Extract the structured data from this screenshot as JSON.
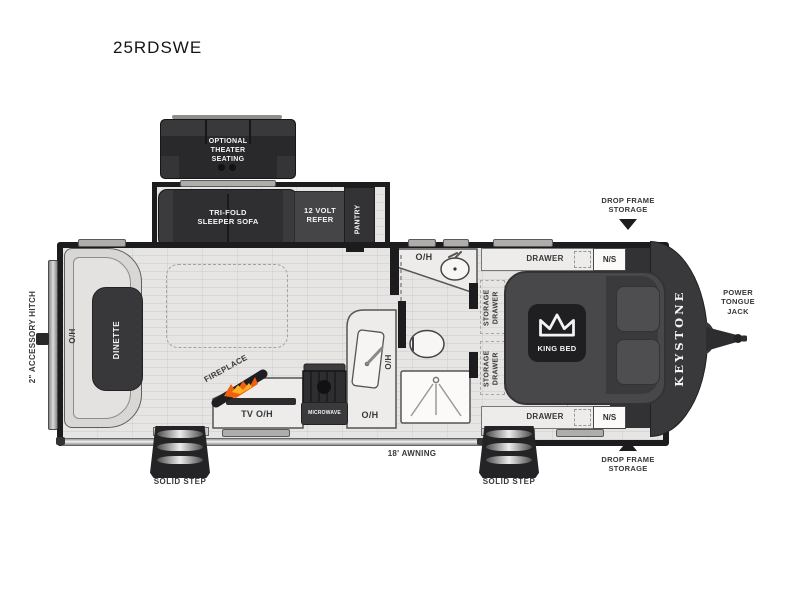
{
  "title": "25RDSWE",
  "brand": "KEYSTONE",
  "options": {
    "theater_seating": "OPTIONAL THEATER SEATING"
  },
  "slideout": {
    "sofa": "TRI-FOLD SLEEPER SOFA",
    "refrigerator": "12 VOLT REFER",
    "pantry": "PANTRY"
  },
  "living_area": {
    "dinette": "DINETTE",
    "dinette_overhead": "O/H",
    "fireplace": "FIREPLACE",
    "tv_overhead": "TV O/H",
    "microwave": "MICROWAVE",
    "kitchen_overhead": "O/H",
    "sink_overhead": "O/H"
  },
  "bathroom": {
    "vanity_overhead": "O/H"
  },
  "bedroom": {
    "drawers": [
      "DRAWER",
      "DRAWER"
    ],
    "nightstands": [
      "N/S",
      "N/S"
    ],
    "storage_drawers": [
      "STORAGE DRAWER",
      "STORAGE DRAWER"
    ],
    "bed": "KING BED"
  },
  "exterior": {
    "accessory_hitch": "2\" ACCESSORY HITCH",
    "power_tongue_jack": "POWER TONGUE JACK",
    "drop_frame_storage_top": "DROP FRAME STORAGE",
    "drop_frame_storage_bottom": "DROP FRAME STORAGE",
    "awning": "18' AWNING",
    "solid_steps": [
      "SOLID STEP",
      "SOLID STEP"
    ]
  },
  "colors": {
    "furniture_dark": "#2f2f31",
    "wall": "#1c1c1e",
    "floor": "#e6e5e3",
    "flame_accent": "#f06010",
    "label_text": "#38383a"
  }
}
